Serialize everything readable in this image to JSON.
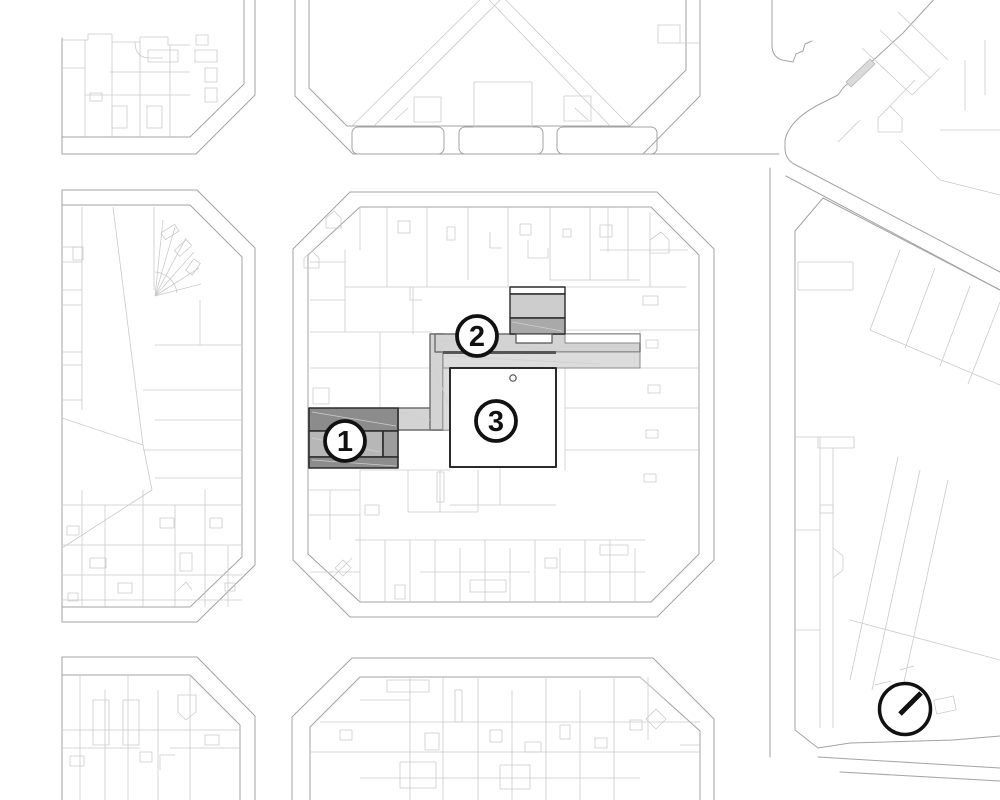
{
  "document": {
    "type": "architectural-site-plan",
    "background": "#ffffff"
  },
  "markers": [
    {
      "label": "1",
      "name": "building-marker"
    },
    {
      "label": "2",
      "name": "walkway-marker"
    },
    {
      "label": "3",
      "name": "courtyard-marker"
    }
  ],
  "icons": {
    "north_arrow": "north-arrow-icon"
  },
  "colors": {
    "street_line": "#a3a3a3",
    "parcel_line": "#cacaca",
    "parcel_line_dark": "#b9b9b9",
    "hairline": "#cfcfcf",
    "project_outline": "#2b2b2b",
    "walkway_outline": "#6e6e6e",
    "building_1_dark": "#8c8c8c",
    "building_1_mid": "#b7b7b7",
    "building_1_mid_right": "#9d9d9d",
    "walkway_fill": "#d3d3d3",
    "walkway_inner_fill": "#dcdcdc",
    "building_2_light": "#cdcdcd",
    "building_2_dark": "#a9a9a9",
    "highlight_sliver": "#dadada",
    "courtyard_fill": "#ffffff",
    "marker_fill": "#ffffff",
    "marker_stroke": "#111111"
  }
}
